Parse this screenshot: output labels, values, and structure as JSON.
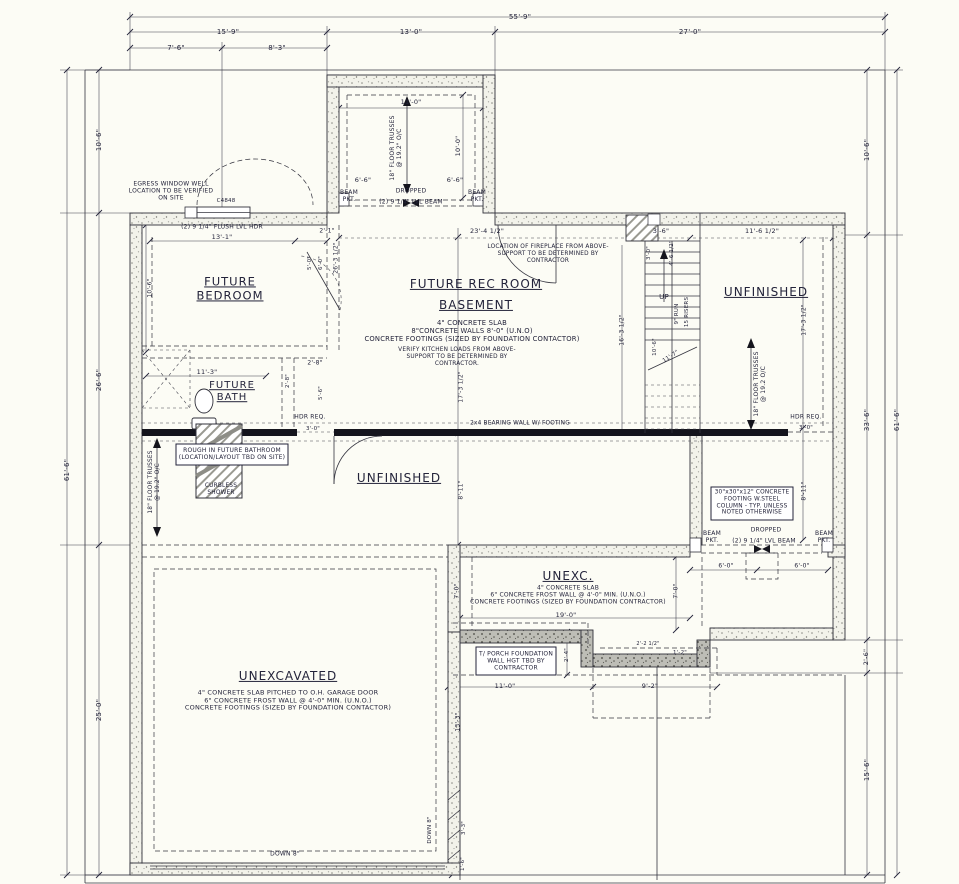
{
  "drawing": {
    "type": "basement-foundation-floor-plan",
    "background": "#fcfcf5",
    "line_color": "#30303a",
    "concrete_wall_fill": "speckled",
    "porch_wall_fill": "gray-stipple"
  },
  "labels": [
    {
      "id": "dim-55-9",
      "text": "55'-9\"",
      "x": 520,
      "y": 17,
      "size": 7
    },
    {
      "id": "dim-15-9",
      "text": "15'-9\"",
      "x": 228,
      "y": 32,
      "size": 7
    },
    {
      "id": "dim-13-0",
      "text": "13'-0\"",
      "x": 411,
      "y": 32,
      "size": 7
    },
    {
      "id": "dim-27-0",
      "text": "27'-0\"",
      "x": 690,
      "y": 32,
      "size": 7
    },
    {
      "id": "dim-7-6",
      "text": "7'-6\"",
      "x": 176,
      "y": 48,
      "size": 7
    },
    {
      "id": "dim-8-3",
      "text": "8'-3\"",
      "x": 277,
      "y": 48,
      "size": 7
    },
    {
      "id": "dim-61-6-left",
      "text": "61'-6\"",
      "x": 67,
      "y": 470,
      "size": 7,
      "rot": -90
    },
    {
      "id": "dim-10-6-left",
      "text": "10'-6\"",
      "x": 99,
      "y": 140,
      "size": 7,
      "rot": -90
    },
    {
      "id": "dim-26-6-left",
      "text": "26'-6\"",
      "x": 99,
      "y": 380,
      "size": 7,
      "rot": -90
    },
    {
      "id": "dim-25-0-left",
      "text": "25'-0\"",
      "x": 99,
      "y": 710,
      "size": 7,
      "rot": -90
    },
    {
      "id": "dim-61-6-right",
      "text": "61'-6\"",
      "x": 897,
      "y": 420,
      "size": 7,
      "rot": -90
    },
    {
      "id": "dim-10-6-right",
      "text": "10'-6\"",
      "x": 867,
      "y": 150,
      "size": 7,
      "rot": -90
    },
    {
      "id": "dim-33-6-right",
      "text": "33'-6\"",
      "x": 867,
      "y": 420,
      "size": 7,
      "rot": -90
    },
    {
      "id": "dim-2-6-right",
      "text": "2'-6\"",
      "x": 867,
      "y": 657,
      "size": 6.5,
      "rot": -90
    },
    {
      "id": "dim-15-6-right",
      "text": "15'-6\"",
      "x": 867,
      "y": 770,
      "size": 7,
      "rot": -90
    },
    {
      "id": "dim-11-0-bump",
      "text": "11'-0\"",
      "x": 411,
      "y": 103,
      "size": 6.5
    },
    {
      "id": "truss-note-bump",
      "text": "18\" FLOOR TRUSSES\n@ 19.2\" O/C",
      "x": 396,
      "y": 148,
      "size": 6,
      "rot": -90
    },
    {
      "id": "dim-10-0-bump",
      "text": "10'-0\"",
      "x": 459,
      "y": 146,
      "size": 6.5,
      "rot": -90
    },
    {
      "id": "dim-6-6-a",
      "text": "6'-6\"",
      "x": 363,
      "y": 181,
      "size": 6.5
    },
    {
      "id": "dim-6-6-b",
      "text": "6'-6\"",
      "x": 455,
      "y": 181,
      "size": 6.5
    },
    {
      "id": "beam-pkt-nw",
      "text": "BEAM\nPKT.",
      "x": 349,
      "y": 196,
      "size": 6
    },
    {
      "id": "beam-pkt-ne",
      "text": "BEAM\nPKT.",
      "x": 477,
      "y": 196,
      "size": 6
    },
    {
      "id": "dropped-bump",
      "text": "DROPPED",
      "x": 411,
      "y": 191,
      "size": 6
    },
    {
      "id": "beam-bump",
      "text": "(2) 9 1/4\" LVL BEAM",
      "x": 411,
      "y": 202,
      "size": 6
    },
    {
      "id": "egress-note",
      "text": "EGRESS WINDOW WELL\nLOCATION TO BE VERIFIED\nON SITE",
      "x": 171,
      "y": 191,
      "size": 6
    },
    {
      "id": "window-label",
      "text": "C4848",
      "x": 226,
      "y": 201,
      "size": 5.5
    },
    {
      "id": "hdr-bedroom",
      "text": "(2) 9 1/4\" FLUSH LVL HDR",
      "x": 222,
      "y": 227,
      "size": 6
    },
    {
      "id": "dim-13-1",
      "text": "13'-1\"",
      "x": 222,
      "y": 238,
      "size": 6.5
    },
    {
      "id": "dim-2-1",
      "text": "2'-1\"",
      "x": 327,
      "y": 231,
      "size": 6
    },
    {
      "id": "room-bedroom",
      "text": "FUTURE\nBEDROOM",
      "x": 230,
      "y": 289,
      "size": 11.5,
      "u": true
    },
    {
      "id": "dim-10-6-bed",
      "text": "10'-6\"",
      "x": 150,
      "y": 288,
      "size": 6,
      "rot": -90
    },
    {
      "id": "dim-26-3-half",
      "text": "26'-3 1/2\"",
      "x": 336,
      "y": 258,
      "size": 6,
      "rot": -90
    },
    {
      "id": "dim-5-0",
      "text": "5'-0\"",
      "x": 310,
      "y": 263,
      "size": 5.5,
      "rot": -90
    },
    {
      "id": "dim-6-0",
      "text": "6'-0\"",
      "x": 321,
      "y": 263,
      "size": 5.5,
      "rot": -90
    },
    {
      "id": "room-recroom",
      "text": "FUTURE REC ROOM",
      "x": 476,
      "y": 284,
      "size": 12,
      "u": true
    },
    {
      "id": "room-basement",
      "text": "BASEMENT",
      "x": 476,
      "y": 305,
      "size": 12,
      "u": true
    },
    {
      "id": "note-basement",
      "text": "4\" CONCRETE SLAB\n8\"CONCRETE WALLS 8'-0\" (U.N.O)\nCONCRETE FOOTINGS (SIZED BY FOUNDATION CONTACTOR)",
      "x": 472,
      "y": 331,
      "size": 6.8
    },
    {
      "id": "note-kitchen",
      "text": "VERIFY KITCHEN LOADS FROM ABOVE-\nSUPPORT TO BE DETERMINED BY\nCONTRACTOR.",
      "x": 457,
      "y": 357,
      "size": 5.8
    },
    {
      "id": "dim-23-4-half",
      "text": "23'-4 1/2\"",
      "x": 487,
      "y": 232,
      "size": 6.5
    },
    {
      "id": "dim-3-6",
      "text": "3'-6\"",
      "x": 661,
      "y": 232,
      "size": 6.5
    },
    {
      "id": "dim-11-6-half",
      "text": "11'-6 1/2\"",
      "x": 762,
      "y": 232,
      "size": 6.5
    },
    {
      "id": "note-fireplace",
      "text": "LOCATION OF FIREPLACE FROM ABOVE-\nSUPPORT TO BE DETERMINED BY\nCONTRACTOR",
      "x": 548,
      "y": 254,
      "size": 5.8
    },
    {
      "id": "dim-3-0-fire",
      "text": "3'-0\"",
      "x": 649,
      "y": 253,
      "size": 5.5,
      "rot": -90
    },
    {
      "id": "dim-4-6-half",
      "text": "4'-6 1/2\"",
      "x": 672,
      "y": 253,
      "size": 5.5,
      "rot": -90
    },
    {
      "id": "room-unfinished-ne",
      "text": "UNFINISHED",
      "x": 766,
      "y": 292,
      "size": 12,
      "u": true
    },
    {
      "id": "dim-17-3-right",
      "text": "17'-3 1/2\"",
      "x": 804,
      "y": 320,
      "size": 6,
      "rot": -90
    },
    {
      "id": "stairs-up",
      "text": "UP",
      "x": 664,
      "y": 297,
      "size": 7
    },
    {
      "id": "stairs-run",
      "text": "9\" RUN",
      "x": 677,
      "y": 314,
      "size": 5.5,
      "rot": -90
    },
    {
      "id": "stairs-risers",
      "text": "15 RISERS",
      "x": 687,
      "y": 312,
      "size": 5.5,
      "rot": -90
    },
    {
      "id": "dim-10-6-stair",
      "text": "10'-6\"",
      "x": 655,
      "y": 347,
      "size": 5.5,
      "rot": -90
    },
    {
      "id": "dim-11-7",
      "text": "11'-7\"",
      "x": 671,
      "y": 357,
      "size": 5.5,
      "rot": -33
    },
    {
      "id": "dim-16-3-half",
      "text": "16'-3 1/2\"",
      "x": 622,
      "y": 330,
      "size": 6,
      "rot": -90
    },
    {
      "id": "truss-note-right",
      "text": "18\" FLOOR TRUSSES\n@ 19.2 O/C",
      "x": 760,
      "y": 384,
      "size": 6,
      "rot": -90
    },
    {
      "id": "hdr-right",
      "text": "HDR REQ.",
      "x": 806,
      "y": 417,
      "size": 6
    },
    {
      "id": "dim-3-0-right",
      "text": "3'-0\"",
      "x": 806,
      "y": 428,
      "size": 5.5
    },
    {
      "id": "dim-2-8-a",
      "text": "2'-8\"",
      "x": 315,
      "y": 363,
      "size": 6
    },
    {
      "id": "dim-11-3",
      "text": "11'-3\"",
      "x": 207,
      "y": 373,
      "size": 6.5
    },
    {
      "id": "room-bath",
      "text": "FUTURE\nBATH",
      "x": 232,
      "y": 392,
      "size": 10,
      "u": true
    },
    {
      "id": "dim-2-8-b",
      "text": "2'-8\"",
      "x": 288,
      "y": 381,
      "size": 5.5,
      "rot": -90
    },
    {
      "id": "dim-5-6",
      "text": "5'-6\"",
      "x": 321,
      "y": 393,
      "size": 5.5,
      "rot": -90
    },
    {
      "id": "hdr-left",
      "text": "HDR REQ.",
      "x": 310,
      "y": 417,
      "size": 6
    },
    {
      "id": "dim-3-0-left",
      "text": "3'-0\"",
      "x": 313,
      "y": 429,
      "size": 5.5
    },
    {
      "id": "dim-17-3-mid",
      "text": "17'-3 1/2\"",
      "x": 461,
      "y": 387,
      "size": 6,
      "rot": -90
    },
    {
      "id": "note-roughin",
      "text": "ROUGH IN FUTURE BATHROOM\n(LOCATION/LAYOUT TBD ON SITE)",
      "x": 232,
      "y": 454,
      "size": 6
    },
    {
      "id": "note-curbless",
      "text": "CURBLESS\nSHOWER",
      "x": 221,
      "y": 490,
      "size": 5.8
    },
    {
      "id": "truss-note-left",
      "text": "18\" FLOOR TRUSSES\n@ 19.2\" O/C",
      "x": 155,
      "y": 482,
      "size": 5.8,
      "rot": -90
    },
    {
      "id": "room-unfinished-mid",
      "text": "UNFINISHED",
      "x": 399,
      "y": 478,
      "size": 12,
      "u": true
    },
    {
      "id": "note-bearing-wall",
      "text": "2x4 BEARING WALL W/ FOOTING",
      "x": 520,
      "y": 424,
      "size": 5.8
    },
    {
      "id": "dim-8-11-mid",
      "text": "8'-11\"",
      "x": 461,
      "y": 490,
      "size": 6,
      "rot": -90
    },
    {
      "id": "dim-8-11-right",
      "text": "8'-11\"",
      "x": 804,
      "y": 491,
      "size": 6,
      "rot": -90
    },
    {
      "id": "note-footing",
      "text": "30\"x30\"x12\" CONCRETE\nFOOTING W.STEEL\nCOLUMN - TYP. UNLESS\nNOTED OTHERWISE",
      "x": 752,
      "y": 503,
      "size": 5.8
    },
    {
      "id": "beam-pkt-sw",
      "text": "BEAM\nPKT.",
      "x": 712,
      "y": 537,
      "size": 6
    },
    {
      "id": "beam-pkt-se",
      "text": "BEAM\nPKT.",
      "x": 824,
      "y": 537,
      "size": 6
    },
    {
      "id": "dropped-unexc",
      "text": "DROPPED",
      "x": 766,
      "y": 530,
      "size": 6
    },
    {
      "id": "beam-unexc",
      "text": "(2) 9 1/4\" LVL BEAM",
      "x": 764,
      "y": 541,
      "size": 6
    },
    {
      "id": "dim-6-0-a",
      "text": "6'-0\"",
      "x": 726,
      "y": 566,
      "size": 6
    },
    {
      "id": "dim-6-0-b",
      "text": "6'-0\"",
      "x": 802,
      "y": 566,
      "size": 6
    },
    {
      "id": "room-unexc",
      "text": "UNEXC.",
      "x": 568,
      "y": 576,
      "size": 12,
      "u": true
    },
    {
      "id": "note-unexc",
      "text": "4\" CONCRETE SLAB\n6\" CONCRETE FROST WALL @ 4'-0\" MIN. (U.N.O.)\nCONCRETE FOOTINGS (SIZED BY FOUNDATION CONTRACTOR)",
      "x": 568,
      "y": 595,
      "size": 6
    },
    {
      "id": "dim-19-0",
      "text": "19'-0\"",
      "x": 566,
      "y": 616,
      "size": 6.5
    },
    {
      "id": "dim-7-0-a",
      "text": "7'-0\"",
      "x": 457,
      "y": 591,
      "size": 6,
      "rot": -90
    },
    {
      "id": "dim-7-0-b",
      "text": "7'-0\"",
      "x": 676,
      "y": 591,
      "size": 6,
      "rot": -90
    },
    {
      "id": "note-porch",
      "text": "T/ PORCH FOUNDATION\nWALL HGT TBD BY\nCONTRACTOR",
      "x": 516,
      "y": 661,
      "size": 6
    },
    {
      "id": "dim-2-4",
      "text": "2'-4\"",
      "x": 567,
      "y": 655,
      "size": 5.5,
      "rot": -90
    },
    {
      "id": "dim-2-2-half",
      "text": "2'-2 1/2\"",
      "x": 648,
      "y": 645,
      "size": 5
    },
    {
      "id": "dim-1-2",
      "text": "1'-2\"",
      "x": 680,
      "y": 653,
      "size": 5.5
    },
    {
      "id": "dim-11-0-porch",
      "text": "11'-0\"",
      "x": 505,
      "y": 687,
      "size": 6.5
    },
    {
      "id": "dim-9-2",
      "text": "9'-2\"",
      "x": 650,
      "y": 687,
      "size": 6.5
    },
    {
      "id": "dim-13-3",
      "text": "13'-3\"",
      "x": 458,
      "y": 722,
      "size": 6,
      "rot": -90
    },
    {
      "id": "room-unexcavated",
      "text": "UNEXCAVATED",
      "x": 288,
      "y": 676,
      "size": 12,
      "u": true
    },
    {
      "id": "note-garage",
      "text": "4\" CONCRETE SLAB PITCHED TO O.H. GARAGE DOOR\n6\" CONCRETE FROST WALL @ 4'-0\" MIN. (U.N.O.)\nCONCRETE FOOTINGS (SIZED BY FOUNDATION CONTACTOR)",
      "x": 288,
      "y": 701,
      "size": 6.5
    },
    {
      "id": "down-8-bottom",
      "text": "DOWN 8\"",
      "x": 285,
      "y": 854,
      "size": 6
    },
    {
      "id": "down-8-side",
      "text": "DOWN 8\"",
      "x": 430,
      "y": 830,
      "size": 5.5,
      "rot": -90
    },
    {
      "id": "dim-3-3",
      "text": "3'-3\"",
      "x": 464,
      "y": 828,
      "size": 5.5,
      "rot": -90
    },
    {
      "id": "dim-1-6",
      "text": "1'-6\"",
      "x": 463,
      "y": 864,
      "size": 5.5,
      "rot": -90
    }
  ]
}
